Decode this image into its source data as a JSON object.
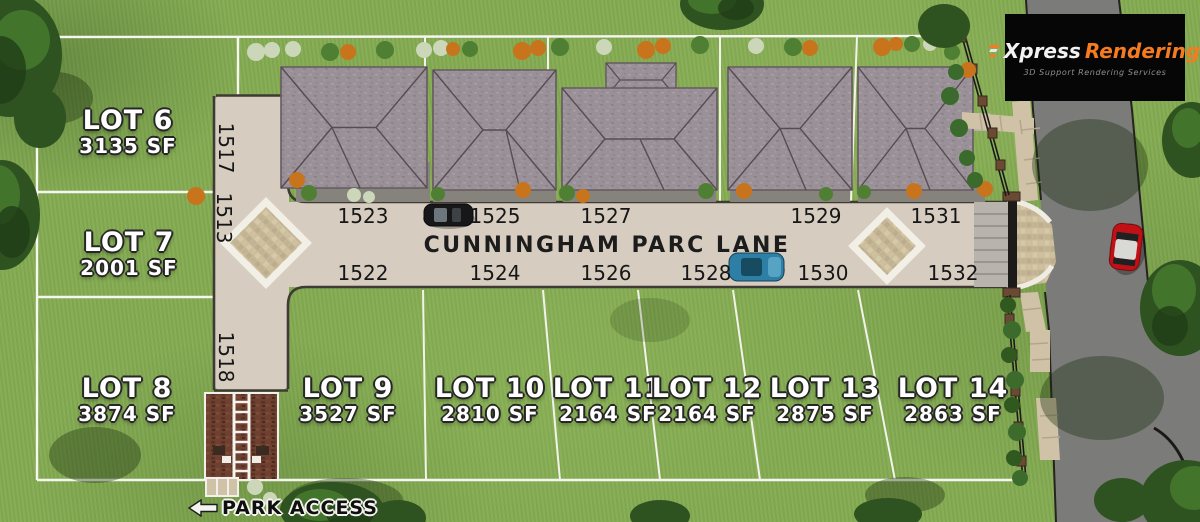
{
  "brand": {
    "logo_first": "Xpress",
    "logo_second": "Rendering",
    "logo_tagline": "3D Support Rendering Services",
    "logo_icon": "speed-lines-icon"
  },
  "map": {
    "street_name": "CUNNINGHAM PARC LANE",
    "park_access": {
      "label": "PARK ACCESS",
      "icon": "arrow-left-icon"
    },
    "lots": [
      {
        "label": "LOT 6",
        "area": "3135 SF"
      },
      {
        "label": "LOT 7",
        "area": "2001 SF"
      },
      {
        "label": "LOT 8",
        "area": "3874 SF"
      },
      {
        "label": "LOT 9",
        "area": "3527 SF"
      },
      {
        "label": "LOT 10",
        "area": "2810 SF"
      },
      {
        "label": "LOT 11",
        "area": "2164 SF"
      },
      {
        "label": "LOT 12",
        "area": "2164 SF"
      },
      {
        "label": "LOT 13",
        "area": "2875 SF"
      },
      {
        "label": "LOT 14",
        "area": "2863 SF"
      }
    ],
    "addresses": {
      "top_row": [
        "1523",
        "1525",
        "1527",
        "1529",
        "1531"
      ],
      "bottom_row": [
        "1522",
        "1524",
        "1526",
        "1528",
        "1530",
        "1532"
      ],
      "side_column": [
        "1517",
        "1513",
        "1518"
      ]
    }
  },
  "colors": {
    "grass": "#84AB52",
    "road_concrete": "#D6CDC0",
    "roof": "#9A9097",
    "asphalt": "#7B7B79",
    "paver": "#C9BB9A",
    "brick_mulch": "#6E4030",
    "accent_orange": "#F47B20",
    "boundary_white": "#F6F5EF"
  }
}
